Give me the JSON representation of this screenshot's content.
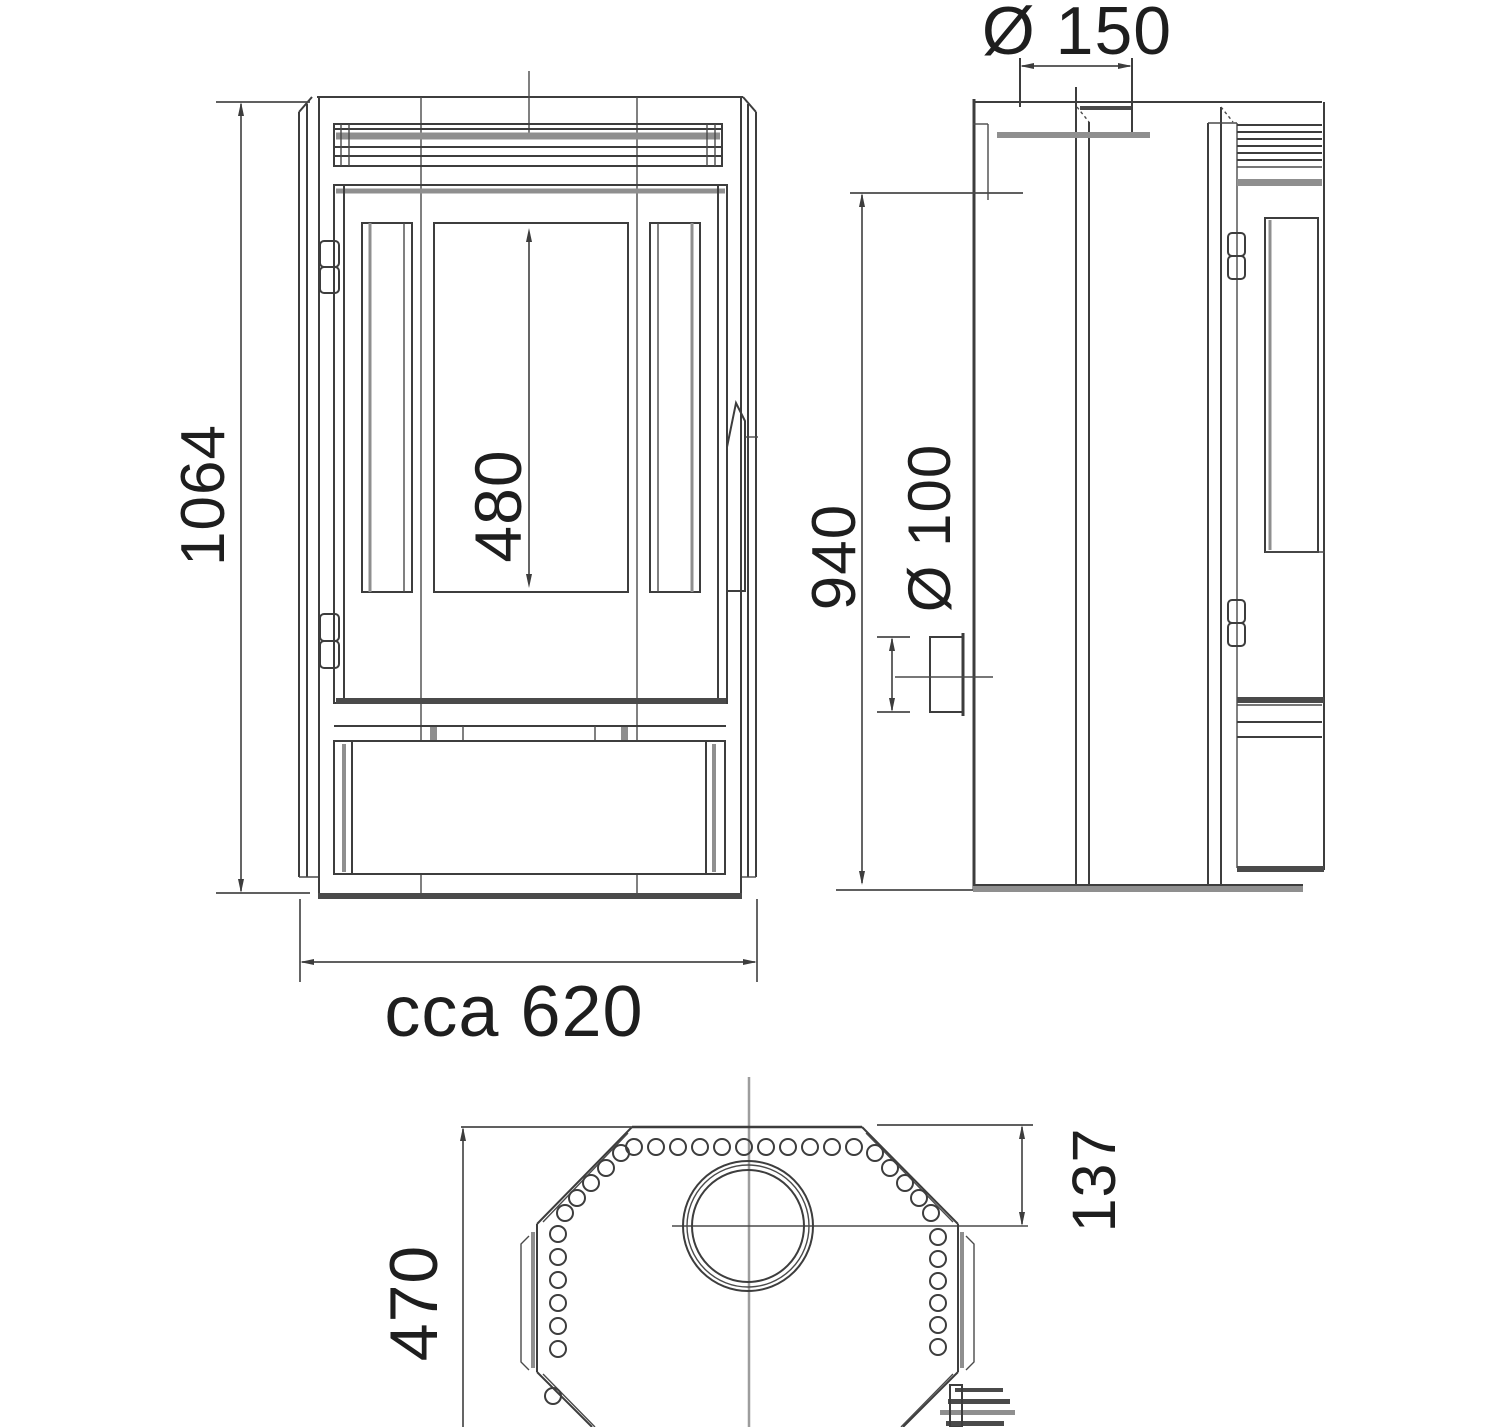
{
  "drawing": {
    "kind": "stove-three-view-dimensional-drawing",
    "background_color": "#ffffff",
    "line_color": "#3d3d3d",
    "accent_gray": "#8f8f8f"
  },
  "dims": {
    "front_height": "1064",
    "door_glass_height": "480",
    "front_width": "cca 620",
    "flue_diameter": "Ø 150",
    "side_height": "940",
    "rear_outlet_diameter": "Ø 100",
    "top_depth": "470",
    "top_flue_offset": "137"
  }
}
